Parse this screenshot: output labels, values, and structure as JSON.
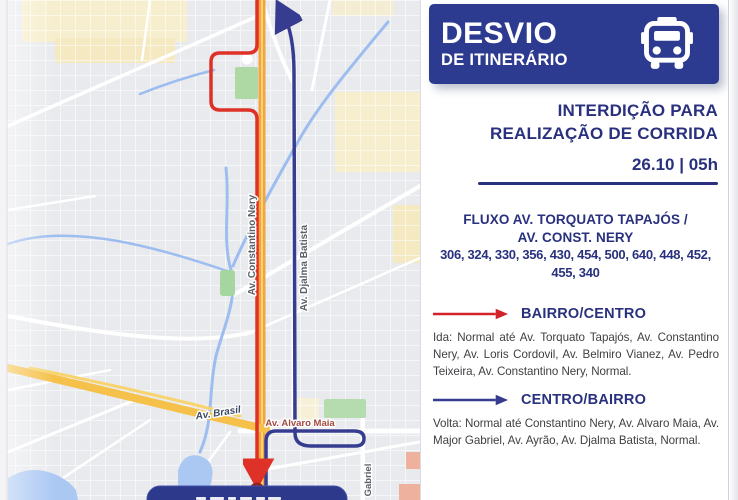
{
  "theme": {
    "navy_header": "#2c3b90",
    "navy_text": "#29317e",
    "red": "#d2232a",
    "route_red": "#de3127",
    "route_blue": "#363c8f",
    "map_bg": "#e9eaed",
    "water": "#abc8f3",
    "park_green": "#aed8a4",
    "road_orange": "#f2a43e",
    "road_yellow": "#f5c14a"
  },
  "header": {
    "title": "DESVIO",
    "subtitle": "DE ITINERÁRIO",
    "icon": "bus-icon"
  },
  "notice": {
    "line1": "INTERDIÇÃO PARA",
    "line2": "REALIZAÇÃO DE CORRIDA",
    "datetime": "26.10 | 05h"
  },
  "flux": {
    "heading1": "FLUXO AV. TORQUATO TAPAJÓS /",
    "heading2": "AV. CONST. NERY",
    "numbers1": "306, 324, 330, 356, 430, 454, 500, 640, 448, 452,",
    "numbers2": "455, 340"
  },
  "directions": [
    {
      "label": "BAIRRO/CENTRO",
      "arrow_color": "#d2232a",
      "text": "Ida: Normal até Av. Torquato Tapajós, Av. Constantino Nery, Av. Loris Cordovil, Av. Belmiro Vianez, Av. Pedro Teixeira, Av. Constantino Nery, Normal."
    },
    {
      "label": "CENTRO/BAIRRO",
      "arrow_color": "#363c8f",
      "text": "Volta: Normal até Constantino Nery, Av. Alvaro Maia, Av. Major Gabriel, Av. Ayrão, Av. Djalma Batista, Normal."
    }
  ],
  "map": {
    "labels": {
      "constantino_nery": "Av. Constantino Nery",
      "djalma_batista": "Av. Djalma Batista",
      "brasil": "Av. Brasil",
      "alvaro_maia": "Av. Alvaro Maia",
      "gabriel": "Gabriel"
    }
  }
}
